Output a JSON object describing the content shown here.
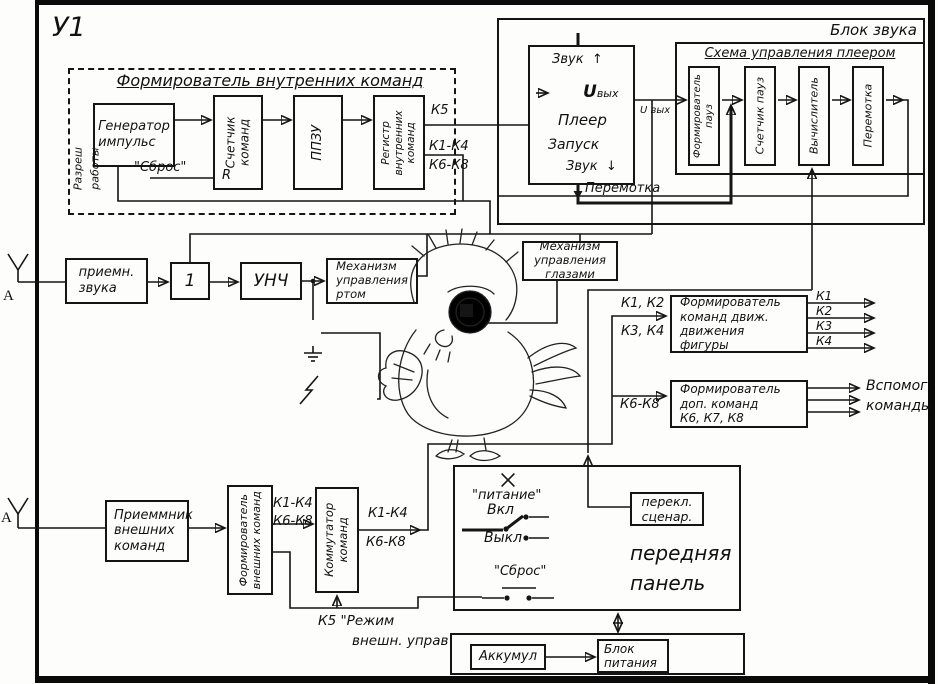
{
  "frame": {
    "title": "У1"
  },
  "internal": {
    "title": "Формирователь внутренних команд",
    "generator": "Генератор\nимпульс",
    "counter": "Счетчик\nкоманд",
    "counter_reset_pin": "R",
    "rom": "ППЗУ",
    "register": "Регистр\nвнутренних\nкоманд",
    "reset": "\"Сброс\"",
    "enable_line1": "Разреш",
    "enable_line2": "работы",
    "out_k5": "К5",
    "out_k1_k4": "К1-К4",
    "out_k6_k8": "К6-К8"
  },
  "sound": {
    "title": "Блок звука",
    "player": {
      "name": "Плеер",
      "start": "Запуск",
      "sound_top": "Звук",
      "arrow_up": "↑",
      "sound_bottom": "Звук",
      "arrow_down": "↓",
      "u": "U",
      "u_sub": "вых",
      "wire_label": "U вых",
      "rewind": "Перемотка"
    },
    "control": {
      "title": "Схема управления плеером",
      "pause_former": "Формирователь\nпауз",
      "pause_counter": "Счетчик пауз",
      "calculator": "Вычислитель",
      "rewind": "Перемотка"
    }
  },
  "sound_chain": {
    "antenna": "А",
    "receiver": "приемн.\nзвука",
    "shaper": "1",
    "amplifier": "УНЧ",
    "mouth": "Механизм\nуправления\nртом",
    "eyes": "Механизм\nуправления\nглазами"
  },
  "movement": {
    "box": "Формирователь\nкоманд движ.\nдвижения\nфигуры",
    "in12": "К1, К2",
    "in34": "К3, К4",
    "outs": [
      "К1",
      "К2",
      "К3",
      "К4"
    ]
  },
  "aux": {
    "box": "Формирователь\nдоп. команд\nК6, К7, К8",
    "in": "К6-К8",
    "out_line1": "Вспомог.",
    "out_line2": "команды"
  },
  "external": {
    "antenna": "А",
    "receiver": "Приеммник\nвнешних\nкоманд",
    "former": "Формирователь\nвнешних команд",
    "k1_k4": "К1-К4",
    "k6_k8": "К6-К8",
    "commutator": "Коммутатор\nкоманд",
    "out_k1_k4": "К1-К4",
    "out_k6_k8": "К6-К8",
    "k5_line1": "К5 \"Режим",
    "k5_line2": "внешн. управ"
  },
  "panel": {
    "name": "передняя\nпанель",
    "power_lamp": "\"питание\"",
    "on": "Вкл",
    "off": "Выкл",
    "reset": "\"Сброс\"",
    "scenario": "перекл.\nсценар."
  },
  "power": {
    "battery": "Аккумул",
    "psu": "Блок\nпитания"
  }
}
